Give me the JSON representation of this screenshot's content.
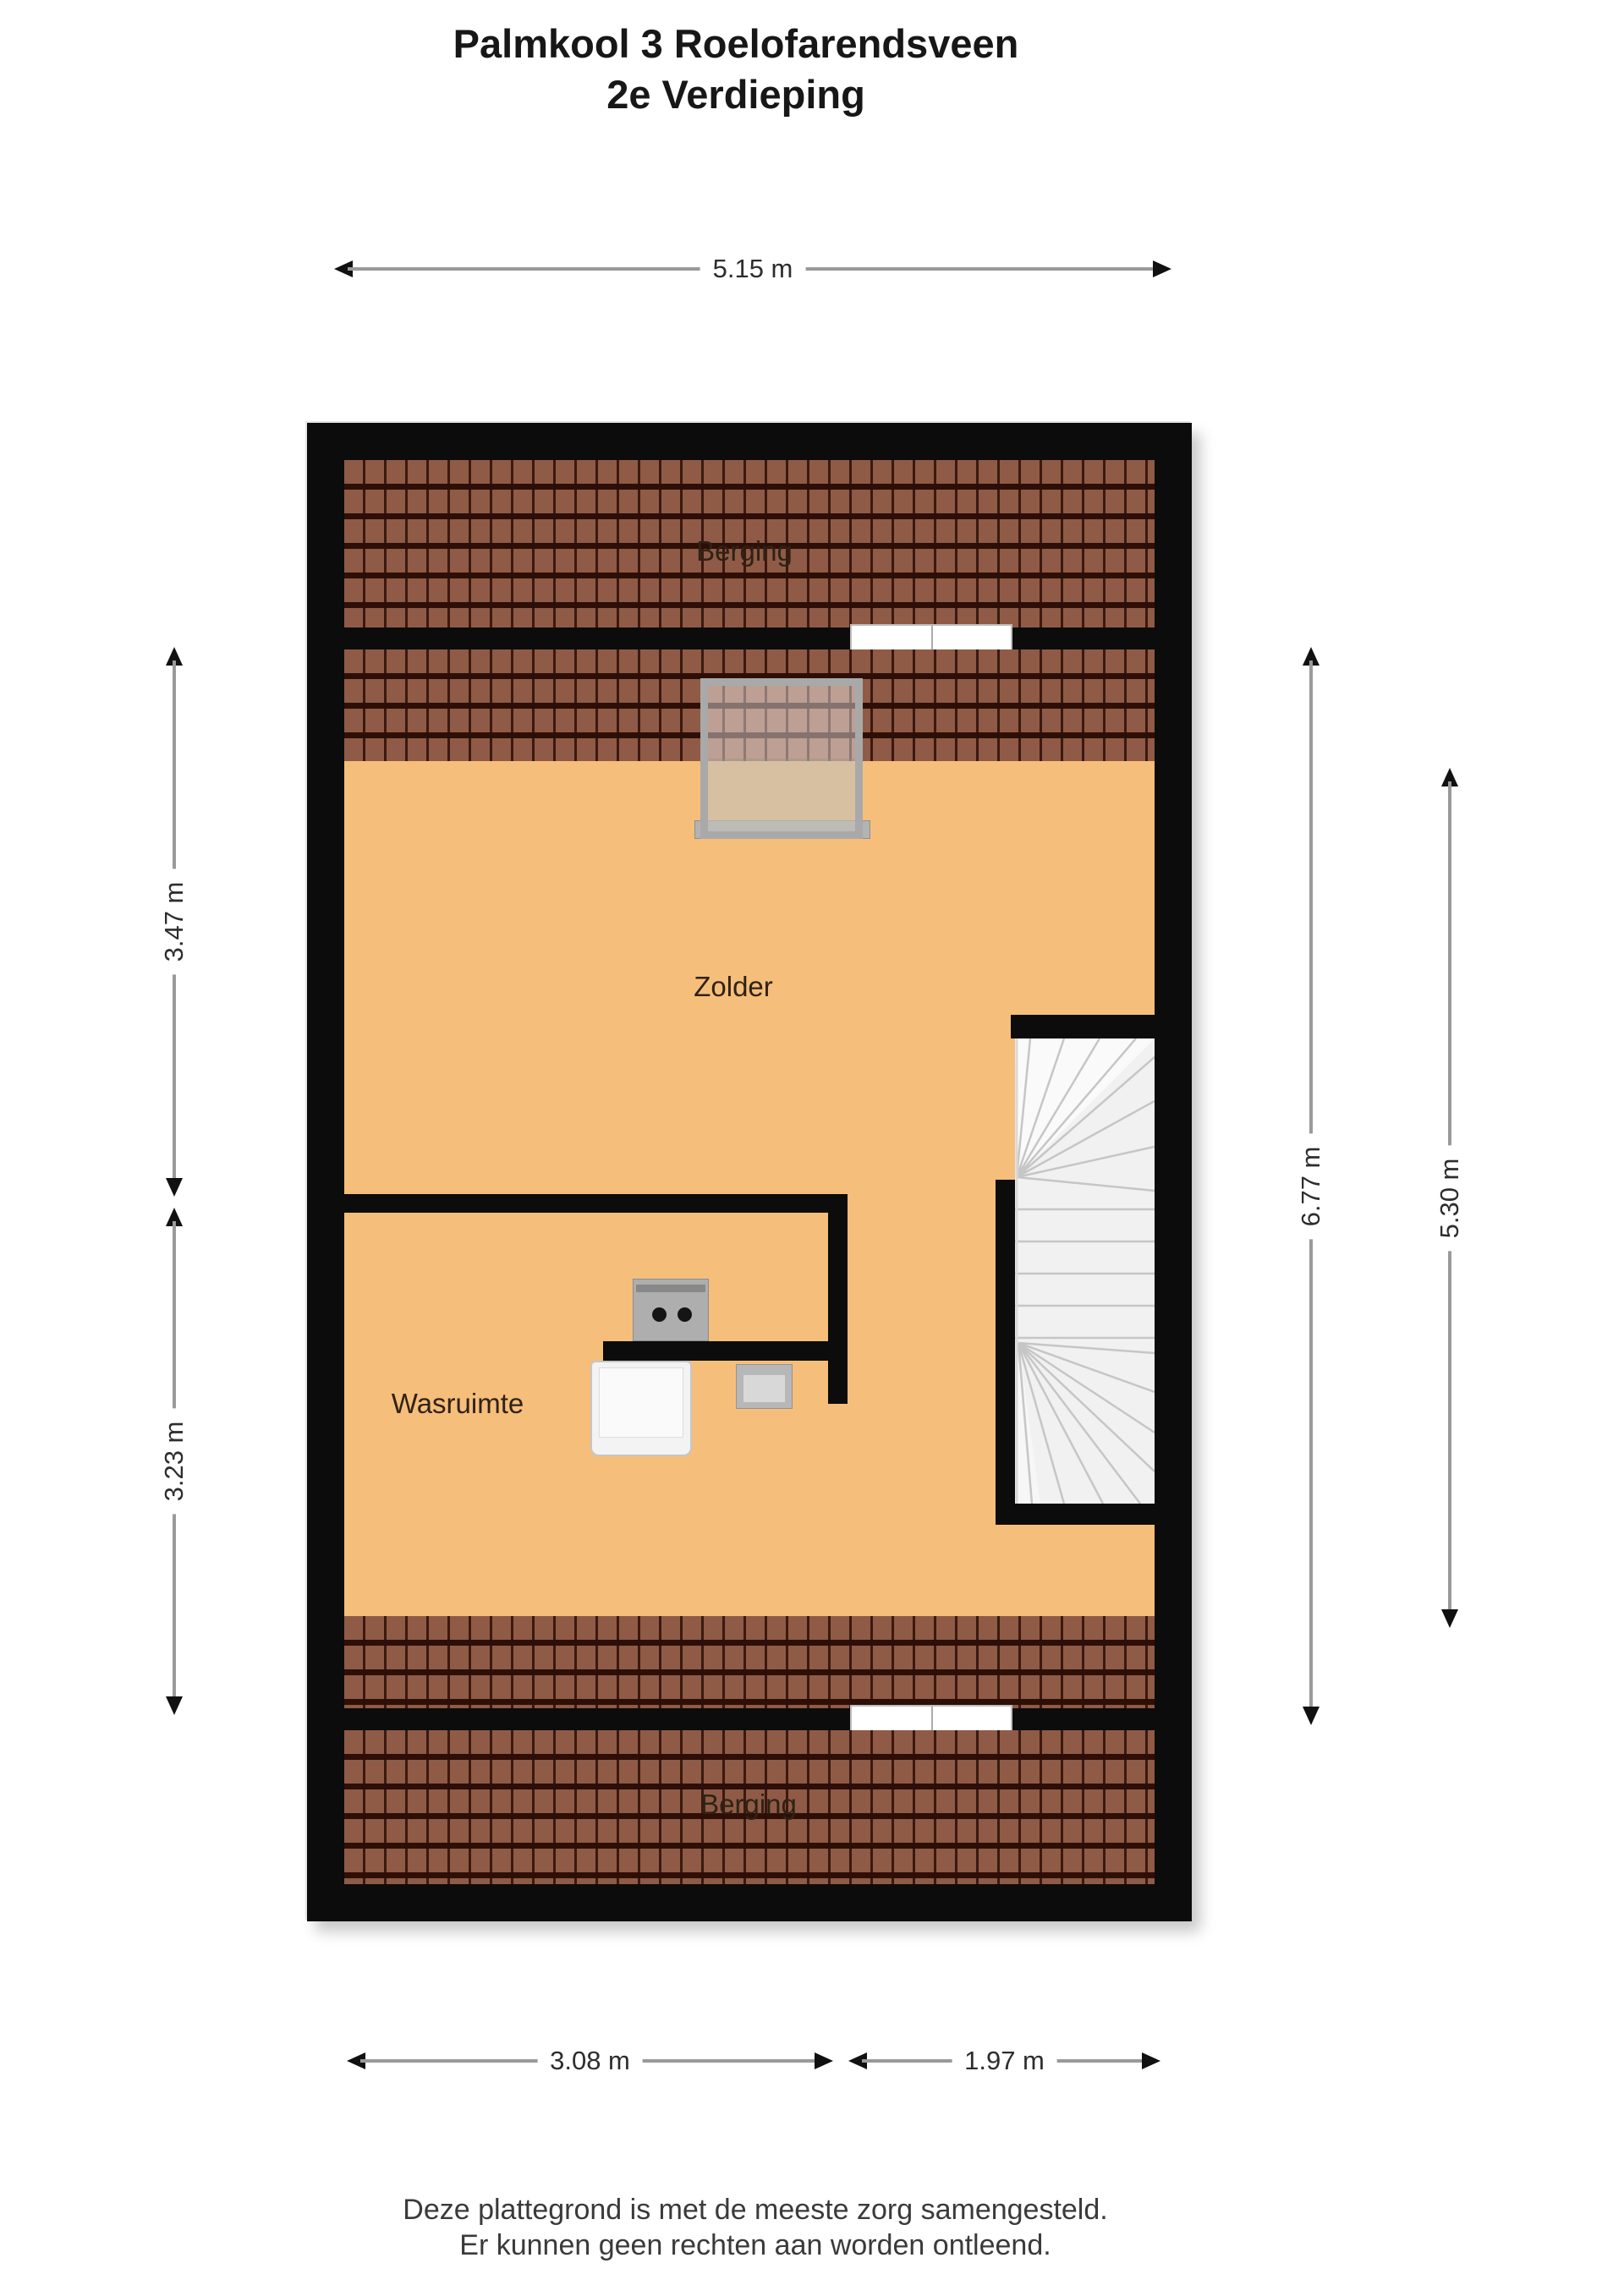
{
  "title": {
    "line1": "Palmkool 3 Roelofarendsveen",
    "line2": "2e Verdieping"
  },
  "rooms": [
    {
      "id": "berging-top",
      "label": "Berging"
    },
    {
      "id": "zolder",
      "label": "Zolder"
    },
    {
      "id": "wasruimte",
      "label": "Wasruimte"
    },
    {
      "id": "berging-bottom",
      "label": "Berging"
    }
  ],
  "dimensions": {
    "top": {
      "label": "5.15 m",
      "edge": "top"
    },
    "left_upper": {
      "label": "3.47 m",
      "edge": "left"
    },
    "left_lower": {
      "label": "3.23 m",
      "edge": "left"
    },
    "right_outer": {
      "label": "6.77 m",
      "edge": "right"
    },
    "right_inner": {
      "label": "5.30 m",
      "edge": "right"
    },
    "bottom_left": {
      "label": "3.08 m",
      "edge": "bottom"
    },
    "bottom_right": {
      "label": "1.97 m",
      "edge": "bottom"
    }
  },
  "features": {
    "icons": [
      "skylight-window-icon",
      "double-door-icon-top",
      "double-door-icon-bottom",
      "boiler-icon",
      "washing-machine-icon",
      "sink-icon",
      "winder-staircase-icon"
    ]
  },
  "footer": {
    "line1": "Deze plattegrond is met de meeste zorg samengesteld.",
    "line2": "Er kunnen geen rechten aan worden ontleend."
  },
  "theme": {
    "wall": "#0c0c0c",
    "floor": "#f6be7b",
    "tile": "#8f5b46",
    "door": "#ffffff",
    "frame": "#a9a9a9",
    "dimline": "#9a9a9a",
    "dimarrow": "#111111",
    "text": "#2d2d2d"
  }
}
